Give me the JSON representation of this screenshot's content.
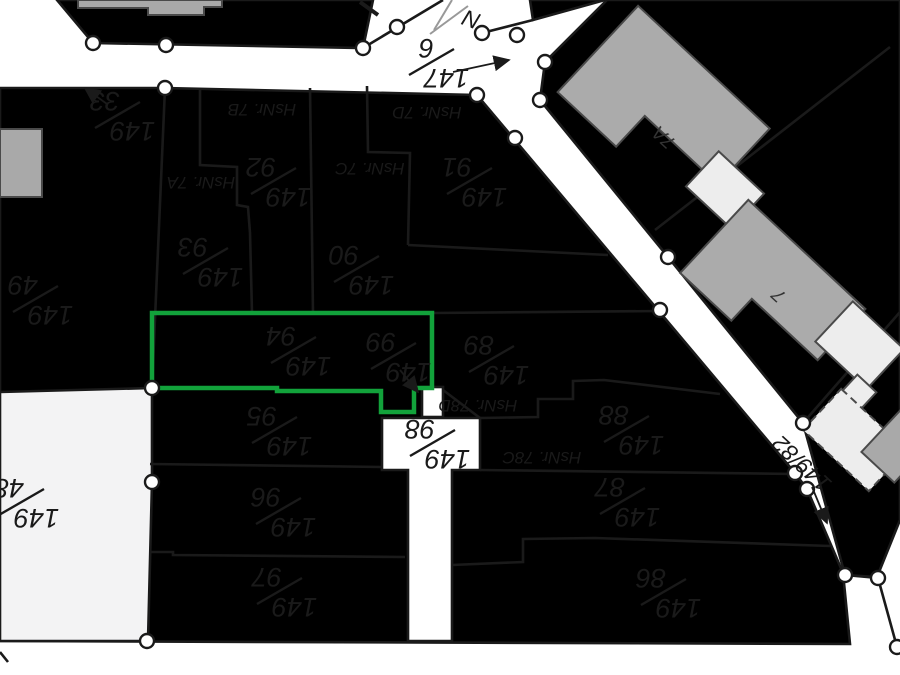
{
  "map": {
    "background": "#ffffff",
    "parcel_fill": "#f8dfe0",
    "muted_parcel_fill": "#f3f3f4",
    "white_parcel_fill": "#ffffff",
    "highlight_color": "#12a23b",
    "building_fill": "#ababab",
    "annex_fill": "#ededed",
    "line_color": "#1a1a1a"
  },
  "highlighted_parcel": {
    "name": "selected-parcel",
    "contains_labels": [
      "149/94",
      "149/99"
    ],
    "outline_color": "#12a23b"
  },
  "parcel_labels": [
    {
      "name": "149-33",
      "num": "149",
      "den": "33",
      "x": 116,
      "y": 116,
      "rot": 180
    },
    {
      "name": "149-49",
      "num": "149",
      "den": "49",
      "x": 34,
      "y": 300,
      "rot": 180
    },
    {
      "name": "149-48",
      "num": "149",
      "den": "48",
      "x": 20,
      "y": 503,
      "rot": 180
    },
    {
      "name": "147-6",
      "num": "147",
      "den": "6",
      "x": 430,
      "y": 63,
      "rot": 180
    },
    {
      "name": "149-92",
      "num": "149",
      "den": "92",
      "x": 272,
      "y": 182,
      "rot": 180
    },
    {
      "name": "149-93",
      "num": "149",
      "den": "93",
      "x": 204,
      "y": 262,
      "rot": 180
    },
    {
      "name": "149-90",
      "num": "149",
      "den": "90",
      "x": 355,
      "y": 270,
      "rot": 180
    },
    {
      "name": "149-91",
      "num": "149",
      "den": "91",
      "x": 468,
      "y": 182,
      "rot": 180
    },
    {
      "name": "149-94",
      "num": "149",
      "den": "94",
      "x": 292,
      "y": 351,
      "rot": 180
    },
    {
      "name": "149-99",
      "num": "149",
      "den": "99",
      "x": 392,
      "y": 357,
      "rot": 180
    },
    {
      "name": "149-89",
      "num": "149",
      "den": "89",
      "x": 490,
      "y": 360,
      "rot": 180
    },
    {
      "name": "149-88",
      "num": "149",
      "den": "88",
      "x": 625,
      "y": 430,
      "rot": 180
    },
    {
      "name": "149-98",
      "num": "149",
      "den": "98",
      "x": 431,
      "y": 444,
      "rot": 180
    },
    {
      "name": "149-87",
      "num": "149",
      "den": "87",
      "x": 621,
      "y": 502,
      "rot": 180
    },
    {
      "name": "149-86",
      "num": "149",
      "den": "86",
      "x": 662,
      "y": 593,
      "rot": 180
    },
    {
      "name": "149-95",
      "num": "149",
      "den": "95",
      "x": 273,
      "y": 431,
      "rot": 180
    },
    {
      "name": "149-96",
      "num": "149",
      "den": "96",
      "x": 277,
      "y": 512,
      "rot": 180
    },
    {
      "name": "149-97",
      "num": "149",
      "den": "97",
      "x": 278,
      "y": 592,
      "rot": 180
    }
  ],
  "house_number_labels": [
    {
      "name": "hsnr-7b",
      "text": "HsNr. 7B",
      "x": 262,
      "y": 104,
      "rot": 180
    },
    {
      "name": "hsnr-7a",
      "text": "HsNr. 7A",
      "x": 201,
      "y": 177,
      "rot": 180
    },
    {
      "name": "hsnr-7c",
      "text": "HsNr. 7C",
      "x": 370,
      "y": 163,
      "rot": 180
    },
    {
      "name": "hsnr-7d",
      "text": "HsNr. 7D",
      "x": 427,
      "y": 107,
      "rot": 180
    },
    {
      "name": "hsnr-78d",
      "text": "HsNr. 78D",
      "x": 478,
      "y": 400,
      "rot": 180
    },
    {
      "name": "hsnr-78c",
      "text": "HsNr. 78C",
      "x": 542,
      "y": 452,
      "rot": 180
    }
  ],
  "text_labels": [
    {
      "name": "road-parcel-label",
      "text": "149/82",
      "x": 807,
      "y": 458,
      "rot": 223,
      "cls": "biglabel"
    },
    {
      "name": "building-label-7a",
      "text": "7A",
      "x": 668,
      "y": 133,
      "rot": 223,
      "cls": "bldlabel"
    },
    {
      "name": "building-label-7",
      "text": "7",
      "x": 783,
      "y": 291,
      "rot": 223,
      "cls": "bldlabel"
    },
    {
      "name": "north-symbol-letter",
      "text": "N",
      "x": 474,
      "y": 12,
      "rot": 200,
      "cls": "biglabel"
    }
  ],
  "leader_arrows": [
    {
      "name": "leader-149-33",
      "x1": 107,
      "y1": 104,
      "x2": 85,
      "y2": 88
    },
    {
      "name": "leader-147-6",
      "x1": 453,
      "y1": 72,
      "x2": 509,
      "y2": 60
    },
    {
      "name": "leader-149-99",
      "x1": 400,
      "y1": 370,
      "x2": 418,
      "y2": 392
    },
    {
      "name": "leader-149-82",
      "x1": 812,
      "y1": 487,
      "x2": 827,
      "y2": 523
    }
  ]
}
